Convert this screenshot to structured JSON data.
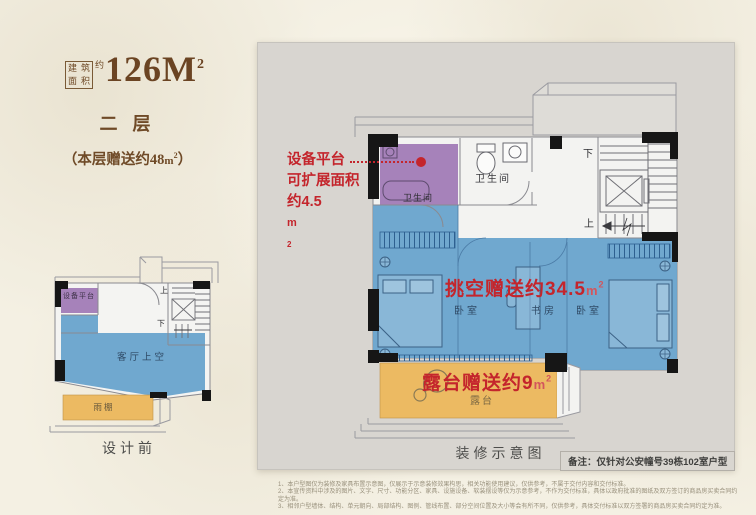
{
  "title_block": {
    "seal_rows": [
      [
        "建",
        "筑"
      ],
      [
        "面",
        "积"
      ]
    ],
    "approx": "约",
    "area_number": "126M",
    "area_sup": "2",
    "floor_name": "二层",
    "bonus_prefix": "（本层赠送约48",
    "bonus_unit": "m",
    "bonus_sup": "2",
    "bonus_suffix": "）"
  },
  "small_plan": {
    "caption": "设计前",
    "labels": {
      "equipment_platform": "设备平台",
      "living_room_void": "客厅上空",
      "canopy": "雨棚",
      "up": "上",
      "down": "下"
    }
  },
  "main_plan": {
    "caption": "装修示意图",
    "note": "备注：仅针对公安幢号39栋102室户型",
    "callout": {
      "line1": "设备平台",
      "line2": "可扩展面积",
      "line3_prefix": "约4.5",
      "unit": "m",
      "unit_sup": "2"
    },
    "void_bonus": {
      "prefix": "挑空赠送约34.5",
      "unit": "m",
      "unit_sup": "2"
    },
    "terrace_bonus": {
      "prefix": "露台赠送约9",
      "unit": "m",
      "unit_sup": "2"
    },
    "rooms": {
      "bath_left": "卫生间",
      "bath_right": "卫生间",
      "bedroom_left": "卧室",
      "study": "书房",
      "bedroom_right": "卧室",
      "terrace": "露台",
      "up": "上",
      "down": "下"
    }
  },
  "footnotes": [
    "1、本户型图仅为装修及家具布置示意图，仅展示于示意装修效果构思，相关功能使用建议，仅供参考，不属于交付内容和交付标准。",
    "2、本宣传资料中涉及的图片、文字、尺寸、功能分区、家具、设施设备、软装摆设等仅为示意参考，不作为交付标准，具体以政府批准的图纸及双方签订的商品房买卖合同约定为准。",
    "3、相邻户型墙体、结构、单元朝向、局部结构、图例、管线布置、部分空间位置及大小等会有所不同，仅供参考，具体交付标准以双方签署的商品房买卖合同约定为准。"
  ],
  "colors": {
    "accent_red": "#c4252c",
    "brown": "#6f4a27",
    "blue": "#68a3cc",
    "purple": "#a17bb6",
    "orange": "#ecba62",
    "panel_gray": "#d8d5d0"
  }
}
